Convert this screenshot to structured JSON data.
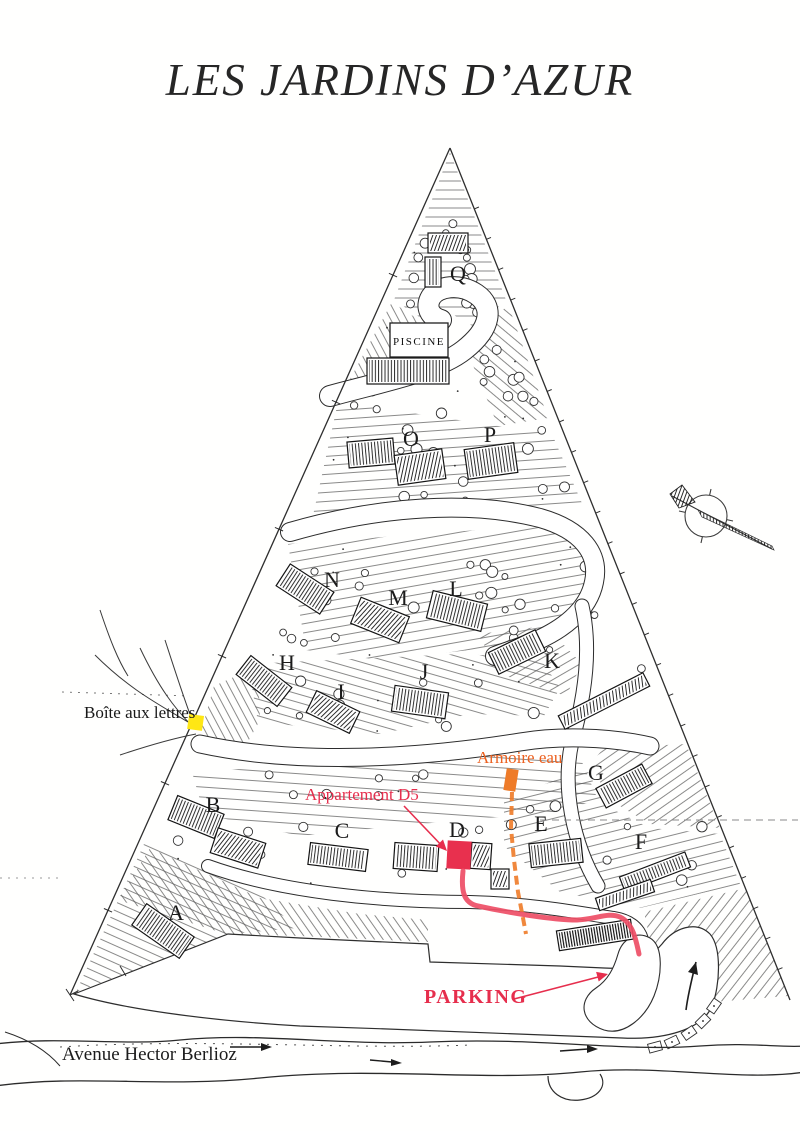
{
  "page": {
    "title": "LES JARDINS D’AZUR"
  },
  "map": {
    "pool_label": "PISCINE",
    "buildings": [
      "A",
      "B",
      "C",
      "D",
      "E",
      "F",
      "G",
      "H",
      "I",
      "J",
      "K",
      "L",
      "M",
      "N",
      "O",
      "P",
      "Q"
    ],
    "annotations": {
      "mailbox": {
        "text": "Boîte aux lettres",
        "marker_color": "#ffe714"
      },
      "apartment_d5": {
        "text": "Appartement D5",
        "color": "#e62e4d"
      },
      "armoire_eau": {
        "text": "Armoire eau",
        "color": "#ec6120"
      },
      "parking": {
        "text": "PARKING",
        "color": "#e62e4d"
      },
      "avenue": {
        "text": "Avenue Hector Berlioz"
      }
    },
    "route_color": "#ee4e66",
    "highlight_d5_color": "#e8304e",
    "water_line_color": "#ee7b28"
  }
}
